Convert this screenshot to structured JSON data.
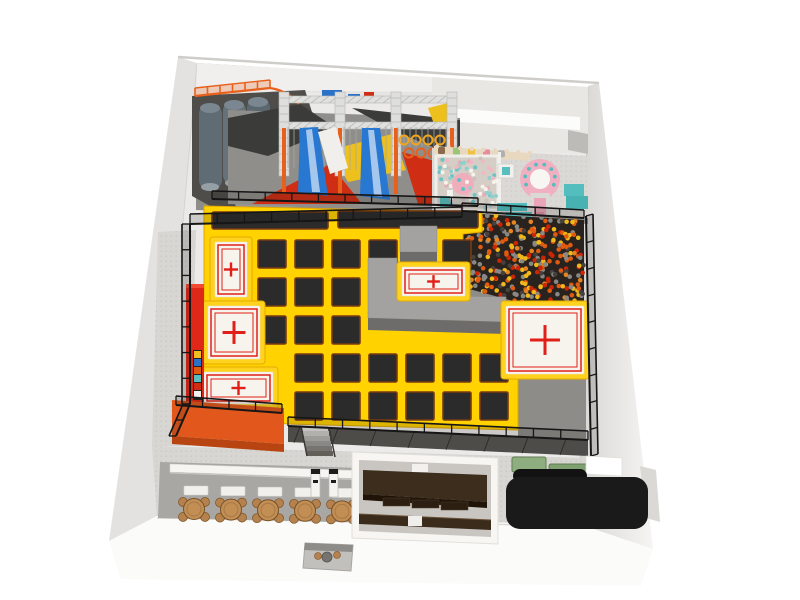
{
  "meta": {
    "scene": "indoor-trampoline-park-top-view-3d-render",
    "canvas": {
      "w": 800,
      "h": 600
    },
    "background": "#ffffff"
  },
  "palette": {
    "court_yellow": "#ffd200",
    "court_yellow_edge": "#e0a800",
    "trampoline_black": "#2b2b2b",
    "trampoline_edge": "#7a3a10",
    "pad_white": "#f7f4ed",
    "marking_red": "#e02018",
    "platform_gray": "#a4a2a0",
    "platform_gray_front": "#6e6c6a",
    "orange_platform": "#e2581c",
    "orange_platform_front": "#b84412",
    "red_wall": "#e02818",
    "fence_black": "#161616",
    "floor_gray_band": "#8f8d89",
    "floor_gray_right": "#8e8c88",
    "walkway_gray": "#d8d6d2",
    "cafe_floor": "#a9a7a3",
    "wall_light": "#e4e2e0",
    "truss_silver": "#dedede",
    "ninja_orange": "#e8611c",
    "slide_gray": "#606c74",
    "ninja_blue": "#2878d2",
    "ninja_red": "#cf2e14",
    "ninja_yellow": "#eec01e",
    "ninja_dark": "#3b3b39",
    "kids_pink": "#f0aebc",
    "kids_teal": "#54bdbd",
    "kids_wall_tan": "#e8d8bf",
    "table_wood": "#c28e54",
    "chair_wood": "#b5824e",
    "party_brown": "#3c2d1d",
    "party_brown_dark": "#201408",
    "desk_black": "#1a1a1a",
    "mat_green": "#8fae80",
    "counter_white": "#f6f5f1"
  },
  "zones": [
    {
      "id": "donut-slides",
      "lane_count": 3
    },
    {
      "id": "ninja-obstacle-course",
      "truss_bays": 3
    },
    {
      "id": "toddler-soft-play",
      "areas": 2
    },
    {
      "id": "ball-pit"
    },
    {
      "id": "free-jump-trampoline-court"
    },
    {
      "id": "air-bag-pads",
      "count": 5
    },
    {
      "id": "cafe-seating"
    },
    {
      "id": "party-room"
    },
    {
      "id": "reception"
    }
  ],
  "court": {
    "grid": {
      "size": 28,
      "cols": [
        258,
        295,
        332,
        369,
        406,
        443,
        480
      ],
      "rows": [
        240,
        278,
        316,
        354,
        392
      ],
      "skip": [
        [
          406,
          240
        ],
        [
          480,
          240
        ],
        [
          369,
          278
        ],
        [
          406,
          278
        ],
        [
          443,
          278
        ],
        [
          480,
          278
        ],
        [
          369,
          316
        ],
        [
          406,
          316
        ],
        [
          443,
          316
        ],
        [
          480,
          316
        ],
        [
          258,
          354
        ],
        [
          258,
          392
        ]
      ]
    },
    "runways": [
      [
        212,
        212,
        116,
        17
      ],
      [
        338,
        211,
        140,
        17
      ]
    ],
    "pads": [
      [
        215,
        242,
        32,
        55
      ],
      [
        208,
        306,
        52,
        53
      ],
      [
        204,
        372,
        69,
        32
      ],
      [
        402,
        267,
        63,
        29
      ],
      [
        506,
        306,
        78,
        68
      ]
    ]
  },
  "ball_pit": {
    "count": 330,
    "radius": 2.3,
    "colors": [
      "#e05a10",
      "#cc2504",
      "#f0b81a",
      "#8a8884",
      "#46413c",
      "#e88420"
    ],
    "weights": [
      0.26,
      0.16,
      0.18,
      0.2,
      0.12,
      0.08
    ],
    "polygon": [
      [
        462,
        213
      ],
      [
        584,
        220
      ],
      [
        584,
        306
      ],
      [
        524,
        304
      ],
      [
        462,
        287
      ]
    ]
  },
  "kids_zone": {
    "ball_count": 85,
    "ball_radius": 2,
    "ball_colors": [
      "#f2b8c2",
      "#6cc4c6",
      "#f7f3ea",
      "#c9c2ba",
      "#8fd0cf",
      "#e9a9b5"
    ],
    "pit_rect": [
      438,
      158,
      58,
      50
    ],
    "decor_colors": [
      "#8a6a4a",
      "#9ac478",
      "#f0c040",
      "#e88aa0",
      "#b0b0ae"
    ],
    "scallop_count": 9,
    "carousel_dot_count": 8
  },
  "ninja": {
    "rope_bays": [
      [
        288,
        336,
        168
      ],
      [
        344,
        392,
        170
      ],
      [
        398,
        448,
        147
      ]
    ],
    "rope_step": 6,
    "rope_top": 127,
    "ring_rows": [
      {
        "y": 140,
        "xs": [
          404,
          416,
          428,
          440
        ],
        "color": "#f0a51e"
      },
      {
        "y": 153,
        "xs": [
          409,
          421,
          433
        ],
        "color": "#e8611c"
      }
    ],
    "truss": {
      "x1": 284,
      "x2": 452,
      "beams_y": [
        96,
        122
      ],
      "beam_h": 7,
      "towers_x": [
        284,
        340,
        396,
        452
      ],
      "tower_top": 92,
      "tower_h": 84
    }
  },
  "fences": [
    [
      190,
      404,
      190,
      224,
      -8,
      0
    ],
    [
      190,
      224,
      462,
      217,
      0,
      -10
    ],
    [
      212,
      199,
      478,
      206,
      0,
      -8
    ],
    [
      586,
      216,
      591,
      456,
      7,
      -2
    ],
    [
      288,
      426,
      588,
      440,
      0,
      -9
    ],
    [
      462,
      211,
      584,
      218,
      0,
      -8
    ],
    [
      176,
      405,
      282,
      413,
      0,
      -9
    ],
    [
      190,
      404,
      176,
      436,
      -7,
      0
    ]
  ],
  "cafe": {
    "table_count": 5,
    "chairs_per_table": 4,
    "first_table_x": 194,
    "table_pitch": 37,
    "table_y": 509,
    "table_radius": 10.5,
    "bench_y": 486,
    "bench_w": 24,
    "bench_h": 9,
    "vending_x": [
      311,
      329,
      367
    ]
  },
  "party_room": {
    "bench_count": 3
  },
  "reception": {
    "mat_count": 2
  },
  "stairs": {
    "step_count": 6,
    "step_colors": [
      "#c6c4c0",
      "#b2b0ac",
      "#9e9c98",
      "#8a8884",
      "#767470",
      "#626058"
    ]
  },
  "color_strip": [
    "#f0c020",
    "#2a72c8",
    "#e05a10",
    "#58bebe",
    "#cf2e14",
    "#f2f0ec"
  ]
}
